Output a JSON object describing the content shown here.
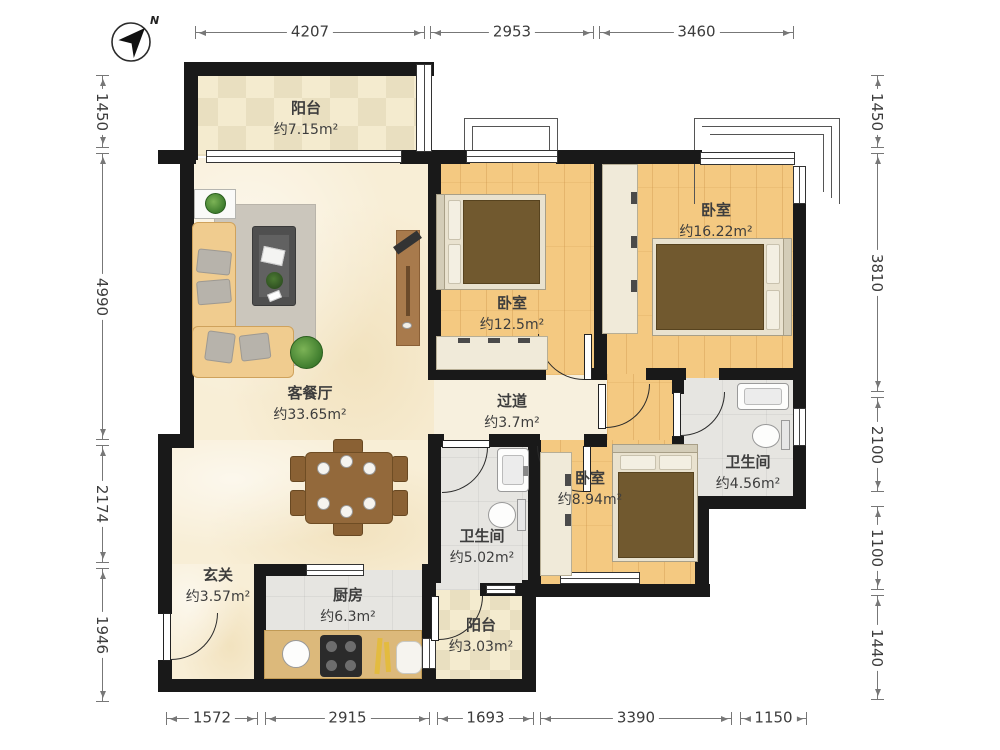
{
  "compass": {
    "north_label": "N"
  },
  "rooms": {
    "balcony_top": {
      "name": "阳台",
      "area": "约7.15m²"
    },
    "living": {
      "name": "客餐厅",
      "area": "约33.65m²"
    },
    "bedroom_mid": {
      "name": "卧室",
      "area": "约12.5m²"
    },
    "bedroom_right": {
      "name": "卧室",
      "area": "约16.22m²"
    },
    "hallway": {
      "name": "过道",
      "area": "约3.7m²"
    },
    "bath_right": {
      "name": "卫生间",
      "area": "约4.56m²"
    },
    "bedroom_small": {
      "name": "卧室",
      "area": "约8.94m²"
    },
    "bath_mid": {
      "name": "卫生间",
      "area": "约5.02m²"
    },
    "entry": {
      "name": "玄关",
      "area": "约3.57m²"
    },
    "kitchen": {
      "name": "厨房",
      "area": "约6.3m²"
    },
    "balcony_bottom": {
      "name": "阳台",
      "area": "约3.03m²"
    }
  },
  "dimensions": {
    "top": [
      "4207",
      "2953",
      "3460"
    ],
    "bottom": [
      "1572",
      "2915",
      "1693",
      "3390",
      "1150"
    ],
    "left": [
      "1450",
      "4990",
      "2174",
      "1946"
    ],
    "right": [
      "1450",
      "3810",
      "2100",
      "1100",
      "1440"
    ]
  },
  "colors": {
    "wall": "#191919",
    "wood_floor": "#f4c981",
    "living_floor": "#f8eed6",
    "tile_floor": "#e6e5e1",
    "balcony_tile": "#f4ebcf",
    "furniture_wood": "#93693b",
    "mattress": "#71592f"
  }
}
